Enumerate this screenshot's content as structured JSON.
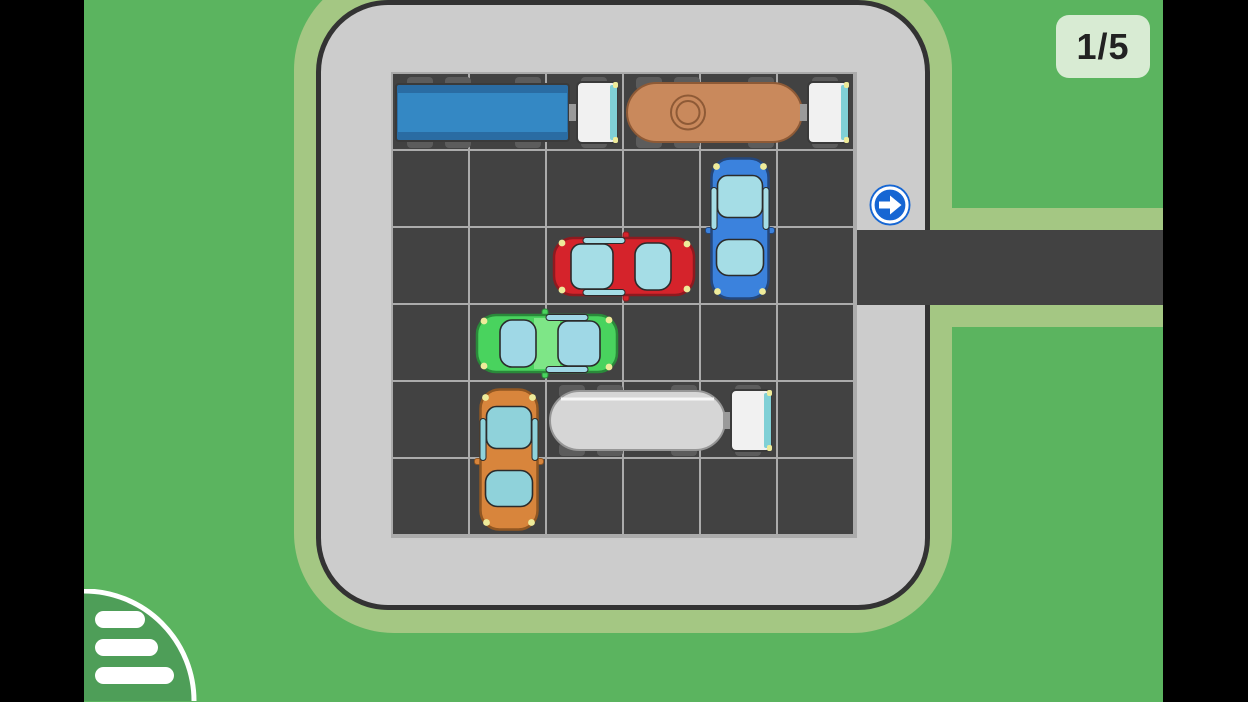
{
  "hud": {
    "level_label": "1/5"
  },
  "colors": {
    "bg_green": "#5bb45f",
    "halo_green": "#a4c783",
    "lot_gray": "#cccccc",
    "lot_border": "#333333",
    "asphalt": "#424242",
    "grid_line": "#ababab",
    "badge_bg": "#d8ebd3",
    "badge_text": "#222222",
    "arrow_blue": "#1666d3",
    "menu_green": "#4e9e58",
    "cab_white": "#f1f1f1",
    "cab_windshield": "#80d0d6",
    "wheel_gray": "#5c5c5c",
    "headlight_yellow": "#eeeb9a"
  },
  "board": {
    "rows": 6,
    "cols": 6,
    "exit_row": 2,
    "exit_side": "right"
  },
  "vehicles": [
    {
      "name": "blue-truck",
      "type": "box-truck",
      "length": 3,
      "row": 0,
      "col": 0,
      "orientation": "horizontal",
      "facing": "right",
      "color": "#3488c4",
      "color_dark": "#2a6ca3",
      "outline": "#3a3a3a"
    },
    {
      "name": "brown-tanker-truck",
      "type": "tanker-truck",
      "length": 3,
      "row": 0,
      "col": 3,
      "orientation": "horizontal",
      "facing": "right",
      "color": "#c9895c",
      "outline": "#8e5a36",
      "manhole": true
    },
    {
      "name": "blue-car",
      "type": "car",
      "length": 2,
      "row": 1,
      "col": 4,
      "orientation": "vertical",
      "facing": "down",
      "color": "#3b82dd",
      "window_color": "#a5dde6",
      "outline": "#24477c"
    },
    {
      "name": "red-car",
      "type": "car",
      "length": 2,
      "row": 2,
      "col": 2,
      "orientation": "horizontal",
      "facing": "right",
      "color": "#d5232b",
      "window_color": "#a5dde6",
      "outline": "#8e1a1f"
    },
    {
      "name": "green-car",
      "type": "car",
      "length": 2,
      "row": 3,
      "col": 1,
      "orientation": "horizontal",
      "facing": "left",
      "color": "#49d35e",
      "window_color": "#9fd8e6",
      "roof_color": "#7ee687",
      "outline": "#2a8a3a"
    },
    {
      "name": "orange-car",
      "type": "car",
      "length": 2,
      "row": 4,
      "col": 1,
      "orientation": "vertical",
      "facing": "down",
      "color": "#d8853c",
      "window_color": "#8fd2da",
      "outline": "#915722"
    },
    {
      "name": "white-tanker-truck",
      "type": "tanker-truck",
      "length": 3,
      "row": 4,
      "col": 2,
      "orientation": "horizontal",
      "facing": "right",
      "color": "#d6d6d6",
      "outline": "#969696",
      "highlight": true
    }
  ],
  "icons": {
    "exit_arrow": "arrow-right-icon",
    "menu": "hamburger-menu-icon"
  }
}
